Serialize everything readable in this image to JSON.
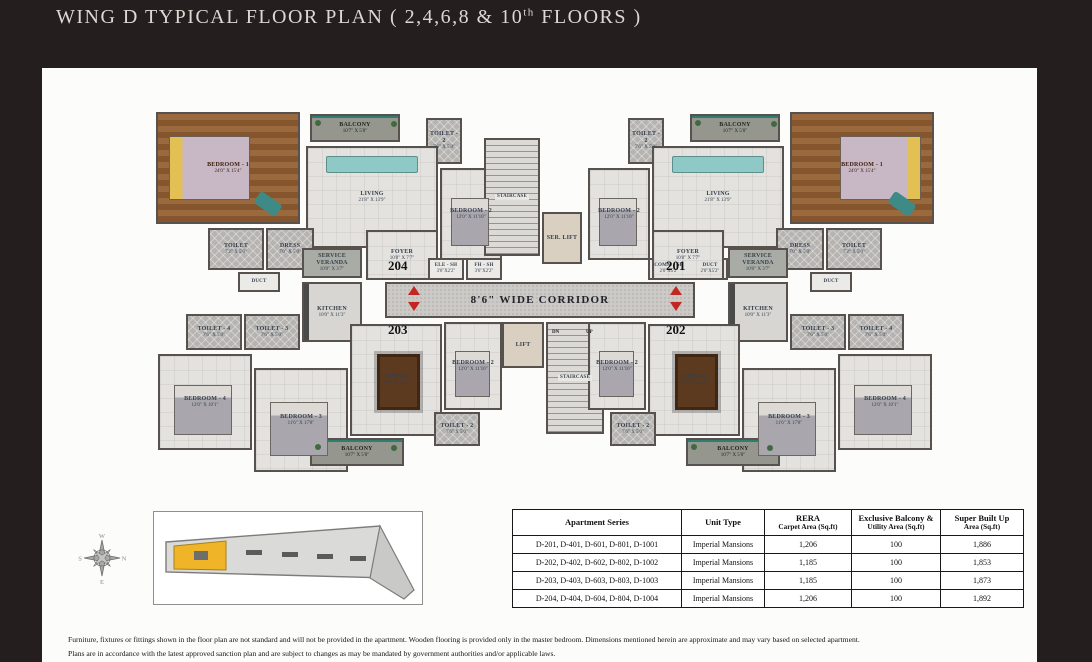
{
  "page": {
    "title_prefix": "WING D TYPICAL FLOOR PLAN ( 2,4,6,8 & 10",
    "title_sup": "th",
    "title_suffix": " FLOORS )"
  },
  "colors": {
    "background": "#241f1e",
    "panel": "#fcfcfb",
    "arrow_red": "#c4271f",
    "keyplan_highlight": "#f0b429",
    "wood_floor": "#8a5a35",
    "window_teal": "#2e7d6e"
  },
  "floor_plan": {
    "units": [
      {
        "label": "204",
        "x": 238,
        "y": 158
      },
      {
        "label": "203",
        "x": 238,
        "y": 222
      },
      {
        "label": "201",
        "x": 516,
        "y": 158
      },
      {
        "label": "202",
        "x": 516,
        "y": 222
      }
    ],
    "arrows": [
      {
        "dir": "up",
        "x": 258,
        "y": 186
      },
      {
        "dir": "down",
        "x": 258,
        "y": 202
      },
      {
        "dir": "up",
        "x": 520,
        "y": 186
      },
      {
        "dir": "down",
        "x": 520,
        "y": 202
      }
    ],
    "stair_notes": [
      {
        "label": "DN",
        "x": 402,
        "y": 230
      },
      {
        "label": "UP",
        "x": 436,
        "y": 230
      }
    ],
    "rooms": [
      {
        "n": "bedroom-1-204",
        "l": "BEDROOM - 1",
        "d": "24'0\" X 15'4\"",
        "x": 6,
        "y": 12,
        "w": 144,
        "h": 112,
        "t": "wood",
        "f": "bed-l"
      },
      {
        "n": "balcony-top-204",
        "l": "BALCONY",
        "d": "10'7\" X 5'0\"",
        "x": 160,
        "y": 14,
        "w": 90,
        "h": 28,
        "t": "balcony"
      },
      {
        "n": "toilet-2-204",
        "l": "TOILET - 2",
        "d": "7'6\" X 5'0\"",
        "x": 276,
        "y": 18,
        "w": 36,
        "h": 46,
        "t": "toilet"
      },
      {
        "n": "living-204",
        "l": "LIVING",
        "d": "21'8\" X 13'9\"",
        "x": 156,
        "y": 46,
        "w": 132,
        "h": 102,
        "t": "marble",
        "f": "sofa"
      },
      {
        "n": "bedroom-2-204",
        "l": "BEDROOM - 2",
        "d": "12'0\" X 11'10\"",
        "x": 290,
        "y": 68,
        "w": 62,
        "h": 92,
        "t": "marble",
        "f": "bed-s"
      },
      {
        "n": "toilet-204",
        "l": "TOILET",
        "d": "7'2\" X 5'0\"",
        "x": 58,
        "y": 128,
        "w": 56,
        "h": 42,
        "t": "toilet"
      },
      {
        "n": "dress-204",
        "l": "DRESS",
        "d": "7'0\" X 5'0\"",
        "x": 116,
        "y": 128,
        "w": 48,
        "h": 42,
        "t": "toilet"
      },
      {
        "n": "duct-204",
        "l": "DUCT",
        "d": "",
        "x": 88,
        "y": 172,
        "w": 42,
        "h": 20,
        "t": "shaft"
      },
      {
        "n": "service-veranda-204",
        "l": "SERVICE VERANDA",
        "d": "10'0\" X 3'7\"",
        "x": 152,
        "y": 148,
        "w": 60,
        "h": 30,
        "t": "veranda"
      },
      {
        "n": "foyer-204",
        "l": "FOYER",
        "d": "10'8\" X 7'7\"",
        "x": 216,
        "y": 130,
        "w": 72,
        "h": 50,
        "t": "marble"
      },
      {
        "n": "kitchen-203",
        "l": "KITCHEN",
        "d": "10'0\" X 11'3\"",
        "x": 152,
        "y": 182,
        "w": 60,
        "h": 60,
        "t": "kitchen"
      },
      {
        "n": "toilet-4-203",
        "l": "TOILET - 4",
        "d": "7'6\" X 5'0\"",
        "x": 36,
        "y": 214,
        "w": 56,
        "h": 36,
        "t": "toilet"
      },
      {
        "n": "toilet-3-203",
        "l": "TOILET - 3",
        "d": "7'6\" X 5'0\"",
        "x": 94,
        "y": 214,
        "w": 56,
        "h": 36,
        "t": "toilet"
      },
      {
        "n": "bedroom-4-203",
        "l": "BEDROOM - 4",
        "d": "12'0\" X 10'1\"",
        "x": 8,
        "y": 254,
        "w": 94,
        "h": 96,
        "t": "marble",
        "f": "bed-s"
      },
      {
        "n": "bedroom-3-203",
        "l": "BEDROOM - 3",
        "d": "11'6\" X 17'8\"",
        "x": 104,
        "y": 268,
        "w": 94,
        "h": 104,
        "t": "marble",
        "f": "bed-s"
      },
      {
        "n": "dining-203",
        "l": "DINING",
        "d": "21'8\" X 12'0\"",
        "x": 200,
        "y": 224,
        "w": 92,
        "h": 112,
        "t": "marble",
        "f": "dining"
      },
      {
        "n": "bedroom-2-203",
        "l": "BEDROOM - 2",
        "d": "12'0\" X 11'10\"",
        "x": 294,
        "y": 222,
        "w": 58,
        "h": 88,
        "t": "marble",
        "f": "bed-s"
      },
      {
        "n": "toilet-2-203",
        "l": "TOILET - 2",
        "d": "7'6\" X 5'0\"",
        "x": 284,
        "y": 312,
        "w": 46,
        "h": 34,
        "t": "toilet"
      },
      {
        "n": "balcony-bottom-203",
        "l": "BALCONY",
        "d": "10'7\" X 5'0\"",
        "x": 160,
        "y": 338,
        "w": 94,
        "h": 28,
        "t": "balcony"
      },
      {
        "n": "staircase-top",
        "l": "STAIRCASE",
        "d": "",
        "x": 334,
        "y": 38,
        "w": 56,
        "h": 118,
        "t": "stairs"
      },
      {
        "n": "service-lift",
        "l": "SER. LIFT",
        "d": "",
        "x": 392,
        "y": 112,
        "w": 40,
        "h": 52,
        "t": "lift"
      },
      {
        "n": "ele-sh",
        "l": "ELE - SH",
        "d": "3'6\"X2'2\"",
        "x": 278,
        "y": 158,
        "w": 36,
        "h": 22,
        "t": "shaft"
      },
      {
        "n": "fh-sh",
        "l": "FH - SH",
        "d": "3'6\"X2'2\"",
        "x": 316,
        "y": 158,
        "w": 36,
        "h": 22,
        "t": "shaft"
      },
      {
        "n": "comm-sh",
        "l": "COMM - SH",
        "d": "2'0\"X5'2\"",
        "x": 498,
        "y": 158,
        "w": 42,
        "h": 22,
        "t": "shaft"
      },
      {
        "n": "duct-sh",
        "l": "DUCT",
        "d": "2'0\"X5'2\"",
        "x": 542,
        "y": 158,
        "w": 36,
        "h": 22,
        "t": "shaft"
      },
      {
        "n": "corridor",
        "l": "8'6\" WIDE CORRIDOR",
        "d": "",
        "x": 235,
        "y": 182,
        "w": 310,
        "h": 36,
        "t": "corridor"
      },
      {
        "n": "lift",
        "l": "LIFT",
        "d": "",
        "x": 352,
        "y": 222,
        "w": 42,
        "h": 46,
        "t": "lift"
      },
      {
        "n": "staircase-bottom",
        "l": "STAIRCASE",
        "d": "",
        "x": 396,
        "y": 222,
        "w": 58,
        "h": 112,
        "t": "stairs"
      },
      {
        "n": "bedroom-1-201",
        "l": "BEDROOM - 1",
        "d": "24'0\" X 15'4\"",
        "x": 640,
        "y": 12,
        "w": 144,
        "h": 112,
        "t": "wood",
        "f": "bed-r"
      },
      {
        "n": "balcony-top-201",
        "l": "BALCONY",
        "d": "10'7\" X 5'0\"",
        "x": 540,
        "y": 14,
        "w": 90,
        "h": 28,
        "t": "balcony"
      },
      {
        "n": "toilet-2-201",
        "l": "TOILET - 2",
        "d": "7'6\" X 5'0\"",
        "x": 478,
        "y": 18,
        "w": 36,
        "h": 46,
        "t": "toilet"
      },
      {
        "n": "living-201",
        "l": "LIVING",
        "d": "21'8\" X 13'9\"",
        "x": 502,
        "y": 46,
        "w": 132,
        "h": 102,
        "t": "marble",
        "f": "sofa"
      },
      {
        "n": "bedroom-2-201",
        "l": "BEDROOM - 2",
        "d": "12'0\" X 11'10\"",
        "x": 438,
        "y": 68,
        "w": 62,
        "h": 92,
        "t": "marble",
        "f": "bed-s"
      },
      {
        "n": "toilet-201",
        "l": "TOILET",
        "d": "7'2\" X 5'0\"",
        "x": 676,
        "y": 128,
        "w": 56,
        "h": 42,
        "t": "toilet"
      },
      {
        "n": "dress-201",
        "l": "DRESS",
        "d": "7'0\" X 5'0\"",
        "x": 626,
        "y": 128,
        "w": 48,
        "h": 42,
        "t": "toilet"
      },
      {
        "n": "duct-201",
        "l": "DUCT",
        "d": "",
        "x": 660,
        "y": 172,
        "w": 42,
        "h": 20,
        "t": "shaft"
      },
      {
        "n": "service-veranda-201",
        "l": "SERVICE VERANDA",
        "d": "10'0\" X 3'7\"",
        "x": 578,
        "y": 148,
        "w": 60,
        "h": 30,
        "t": "veranda"
      },
      {
        "n": "foyer-201",
        "l": "FOYER",
        "d": "10'8\" X 7'7\"",
        "x": 502,
        "y": 130,
        "w": 72,
        "h": 50,
        "t": "marble"
      },
      {
        "n": "kitchen-202",
        "l": "KITCHEN",
        "d": "10'0\" X 11'3\"",
        "x": 578,
        "y": 182,
        "w": 60,
        "h": 60,
        "t": "kitchen"
      },
      {
        "n": "toilet-4-202",
        "l": "TOILET - 4",
        "d": "7'6\" X 5'0\"",
        "x": 698,
        "y": 214,
        "w": 56,
        "h": 36,
        "t": "toilet"
      },
      {
        "n": "toilet-3-202",
        "l": "TOILET - 3",
        "d": "7'6\" X 5'0\"",
        "x": 640,
        "y": 214,
        "w": 56,
        "h": 36,
        "t": "toilet"
      },
      {
        "n": "bedroom-4-202",
        "l": "BEDROOM - 4",
        "d": "12'0\" X 10'1\"",
        "x": 688,
        "y": 254,
        "w": 94,
        "h": 96,
        "t": "marble",
        "f": "bed-s"
      },
      {
        "n": "bedroom-3-202",
        "l": "BEDROOM - 3",
        "d": "11'6\" X 17'8\"",
        "x": 592,
        "y": 268,
        "w": 94,
        "h": 104,
        "t": "marble",
        "f": "bed-s"
      },
      {
        "n": "dining-202",
        "l": "DINING",
        "d": "21'8\" X 12'0\"",
        "x": 498,
        "y": 224,
        "w": 92,
        "h": 112,
        "t": "marble",
        "f": "dining"
      },
      {
        "n": "bedroom-2-202",
        "l": "BEDROOM - 2",
        "d": "12'0\" X 11'10\"",
        "x": 438,
        "y": 222,
        "w": 58,
        "h": 88,
        "t": "marble",
        "f": "bed-s"
      },
      {
        "n": "toilet-2-202",
        "l": "TOILET - 2",
        "d": "7'6\" X 5'0\"",
        "x": 460,
        "y": 312,
        "w": 46,
        "h": 34,
        "t": "toilet"
      },
      {
        "n": "balcony-bottom-202",
        "l": "BALCONY",
        "d": "10'7\" X 5'0\"",
        "x": 536,
        "y": 338,
        "w": 94,
        "h": 28,
        "t": "balcony"
      }
    ]
  },
  "key_plan": {
    "compass": {
      "top": "W",
      "right": "N",
      "left": "S",
      "bottom": "E"
    }
  },
  "table": {
    "headers": [
      {
        "line1": "Apartment Series",
        "line2": ""
      },
      {
        "line1": "Unit Type",
        "line2": ""
      },
      {
        "line1": "RERA",
        "line2": "Carpet Area (Sq.ft)"
      },
      {
        "line1": "Exclusive Balcony &",
        "line2": "Utility Area (Sq.ft)"
      },
      {
        "line1": "Super Built Up",
        "line2": "Area (Sq.ft)"
      }
    ],
    "rows": [
      [
        "D-201, D-401, D-601, D-801, D-1001",
        "Imperial Mansions",
        "1,206",
        "100",
        "1,886"
      ],
      [
        "D-202, D-402, D-602, D-802, D-1002",
        "Imperial Mansions",
        "1,185",
        "100",
        "1,853"
      ],
      [
        "D-203, D-403, D-603, D-803, D-1003",
        "Imperial Mansions",
        "1,185",
        "100",
        "1,873"
      ],
      [
        "D-204, D-404, D-604, D-804, D-1004",
        "Imperial Mansions",
        "1,206",
        "100",
        "1,892"
      ]
    ]
  },
  "disclaimer": {
    "line1": "Furniture, fixtures or fittings shown in the floor plan are not standard and will not be provided in the apartment. Wooden flooring is provided only in the master bedroom. Dimensions mentioned herein are approximate and may vary based on selected apartment.",
    "line2": "Plans are in accordance with the latest approved sanction plan and are subject to changes as may be mandated by government authorities and/or applicable laws."
  }
}
